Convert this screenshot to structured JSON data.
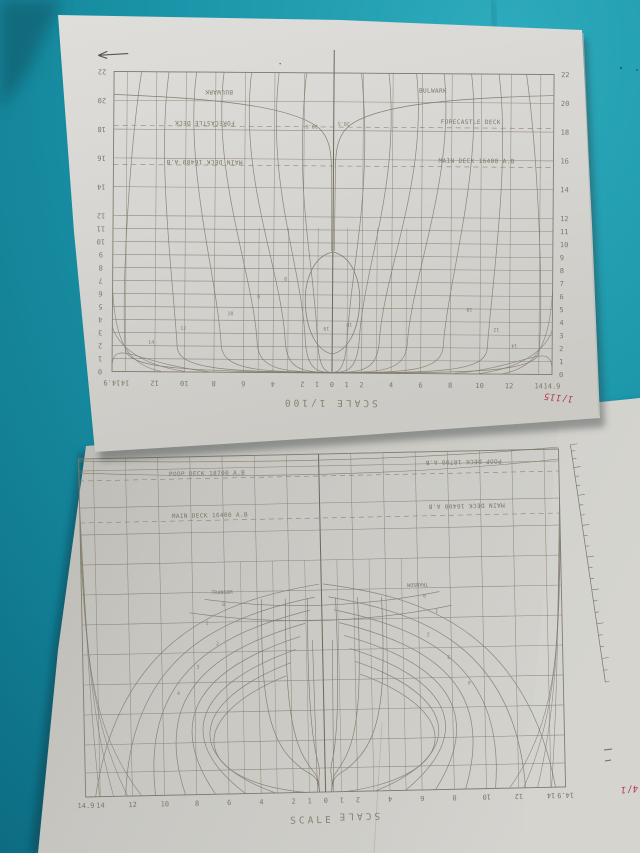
{
  "scene": {
    "description": "Two ship lines-plan (body plan) drawings on paper sheets lying on teal fabric",
    "colors": {
      "fabric_teal": "#1b95a9",
      "fabric_shadow": "#0b6278",
      "paper_top": "#d7d6d2",
      "paper_bottom": "#c7c6c1",
      "drawing_line": "#837d6e",
      "red_ink": "#b23a50",
      "pencil": "#57544e"
    }
  },
  "top_sheet": {
    "scale_label": "SCALE 1/100",
    "red_annotation": "1/115",
    "deck_lines": {
      "bulwark": "BULWARK",
      "forecastle": "FORECASTLE DECK",
      "main_deck": "MAIN DECK 16400 A.B"
    },
    "waterline_labels": [
      "0",
      "1",
      "2",
      "3",
      "4",
      "5",
      "6",
      "7",
      "8",
      "9",
      "10",
      "11",
      "12",
      "14",
      "16",
      "18",
      "20",
      "22"
    ],
    "station_labels_left": [
      "14.9",
      "14",
      "12",
      "10",
      "8",
      "6",
      "4",
      "2",
      "1"
    ],
    "center_station_label": "0",
    "station_labels_right": [
      "1",
      "2",
      "4",
      "6",
      "8",
      "10",
      "12",
      "14",
      "14.9"
    ],
    "curve_annotations": [
      {
        "t": "20.5",
        "x": 311,
        "y": 129,
        "r": 180
      },
      {
        "t": "20.5",
        "x": 343,
        "y": 126,
        "r": 180
      },
      {
        "t": "19",
        "x": 327,
        "y": 331,
        "r": 180
      },
      {
        "t": "19",
        "x": 350,
        "y": 327,
        "r": 180
      },
      {
        "t": "14",
        "x": 152,
        "y": 345,
        "r": 0
      },
      {
        "t": "12",
        "x": 184,
        "y": 331,
        "r": 0
      },
      {
        "t": "10",
        "x": 231,
        "y": 316,
        "r": 0
      },
      {
        "t": "9",
        "x": 259,
        "y": 299,
        "r": 0
      },
      {
        "t": "8",
        "x": 286,
        "y": 281,
        "r": 0
      },
      {
        "t": "10",
        "x": 470,
        "y": 311,
        "r": 180
      },
      {
        "t": "12",
        "x": 497,
        "y": 331,
        "r": 180
      },
      {
        "t": "14",
        "x": 515,
        "y": 347,
        "r": 180
      }
    ]
  },
  "bottom_sheet": {
    "scale_label": "SCALE",
    "scale_label_rotated": "SCALE",
    "red_annotation": "4/1",
    "deck_lines": {
      "poop": "POOP DECK 18700 A.B",
      "main_deck": "MAIN DECK 16400 A.B"
    },
    "transom_label": "TRANSOM",
    "station_labels_left": [
      "14.9",
      "14",
      "12",
      "10",
      "8",
      "6",
      "4",
      "2",
      "1"
    ],
    "center_station_label": "0",
    "station_labels_right": [
      "1",
      "2",
      "4",
      "6",
      "8",
      "10",
      "12",
      "14",
      "14.9"
    ],
    "curve_annotations": [
      {
        "t": "0",
        "x": 224,
        "y": 604,
        "r": 0
      },
      {
        "t": "1",
        "x": 207,
        "y": 622,
        "r": 0
      },
      {
        "t": "2",
        "x": 217,
        "y": 643,
        "r": 0
      },
      {
        "t": "3",
        "x": 197,
        "y": 666,
        "r": 0
      },
      {
        "t": "4",
        "x": 177,
        "y": 692,
        "r": 0
      },
      {
        "t": "0",
        "x": 425,
        "y": 600,
        "r": 180
      },
      {
        "t": "1",
        "x": 437,
        "y": 616,
        "r": 180
      },
      {
        "t": "2",
        "x": 428,
        "y": 639,
        "r": 180
      },
      {
        "t": "3",
        "x": 448,
        "y": 662,
        "r": 180
      },
      {
        "t": "4",
        "x": 468,
        "y": 688,
        "r": 180
      }
    ]
  },
  "chart_data": [
    {
      "type": "line",
      "title": "Body plan (upper sheet), text rotated 180°",
      "xlabel": "half-breadth stations",
      "ylabel": "waterlines",
      "x_ticks": [
        14.9,
        14,
        12,
        10,
        8,
        6,
        4,
        2,
        1,
        0,
        1,
        2,
        4,
        6,
        8,
        10,
        12,
        14,
        14.9
      ],
      "y_ticks": [
        0,
        1,
        2,
        3,
        4,
        5,
        6,
        7,
        8,
        9,
        10,
        11,
        12,
        14,
        16,
        18,
        20,
        22
      ],
      "annotations": [
        "BULWARK",
        "FORECASTLE DECK",
        "MAIN DECK 16400 A.B",
        "20.5",
        "19",
        "SCALE 1/100"
      ]
    },
    {
      "type": "line",
      "title": "Body plan / stern lines (lower sheet)",
      "xlabel": "half-breadth stations",
      "x_ticks": [
        14.9,
        14,
        12,
        10,
        8,
        6,
        4,
        2,
        1,
        0,
        1,
        2,
        4,
        6,
        8,
        10,
        12,
        14,
        14.9
      ],
      "annotations": [
        "POOP DECK 18700 A.B",
        "MAIN DECK 16400 A.B",
        "TRANSOM",
        "SCALE"
      ]
    }
  ]
}
